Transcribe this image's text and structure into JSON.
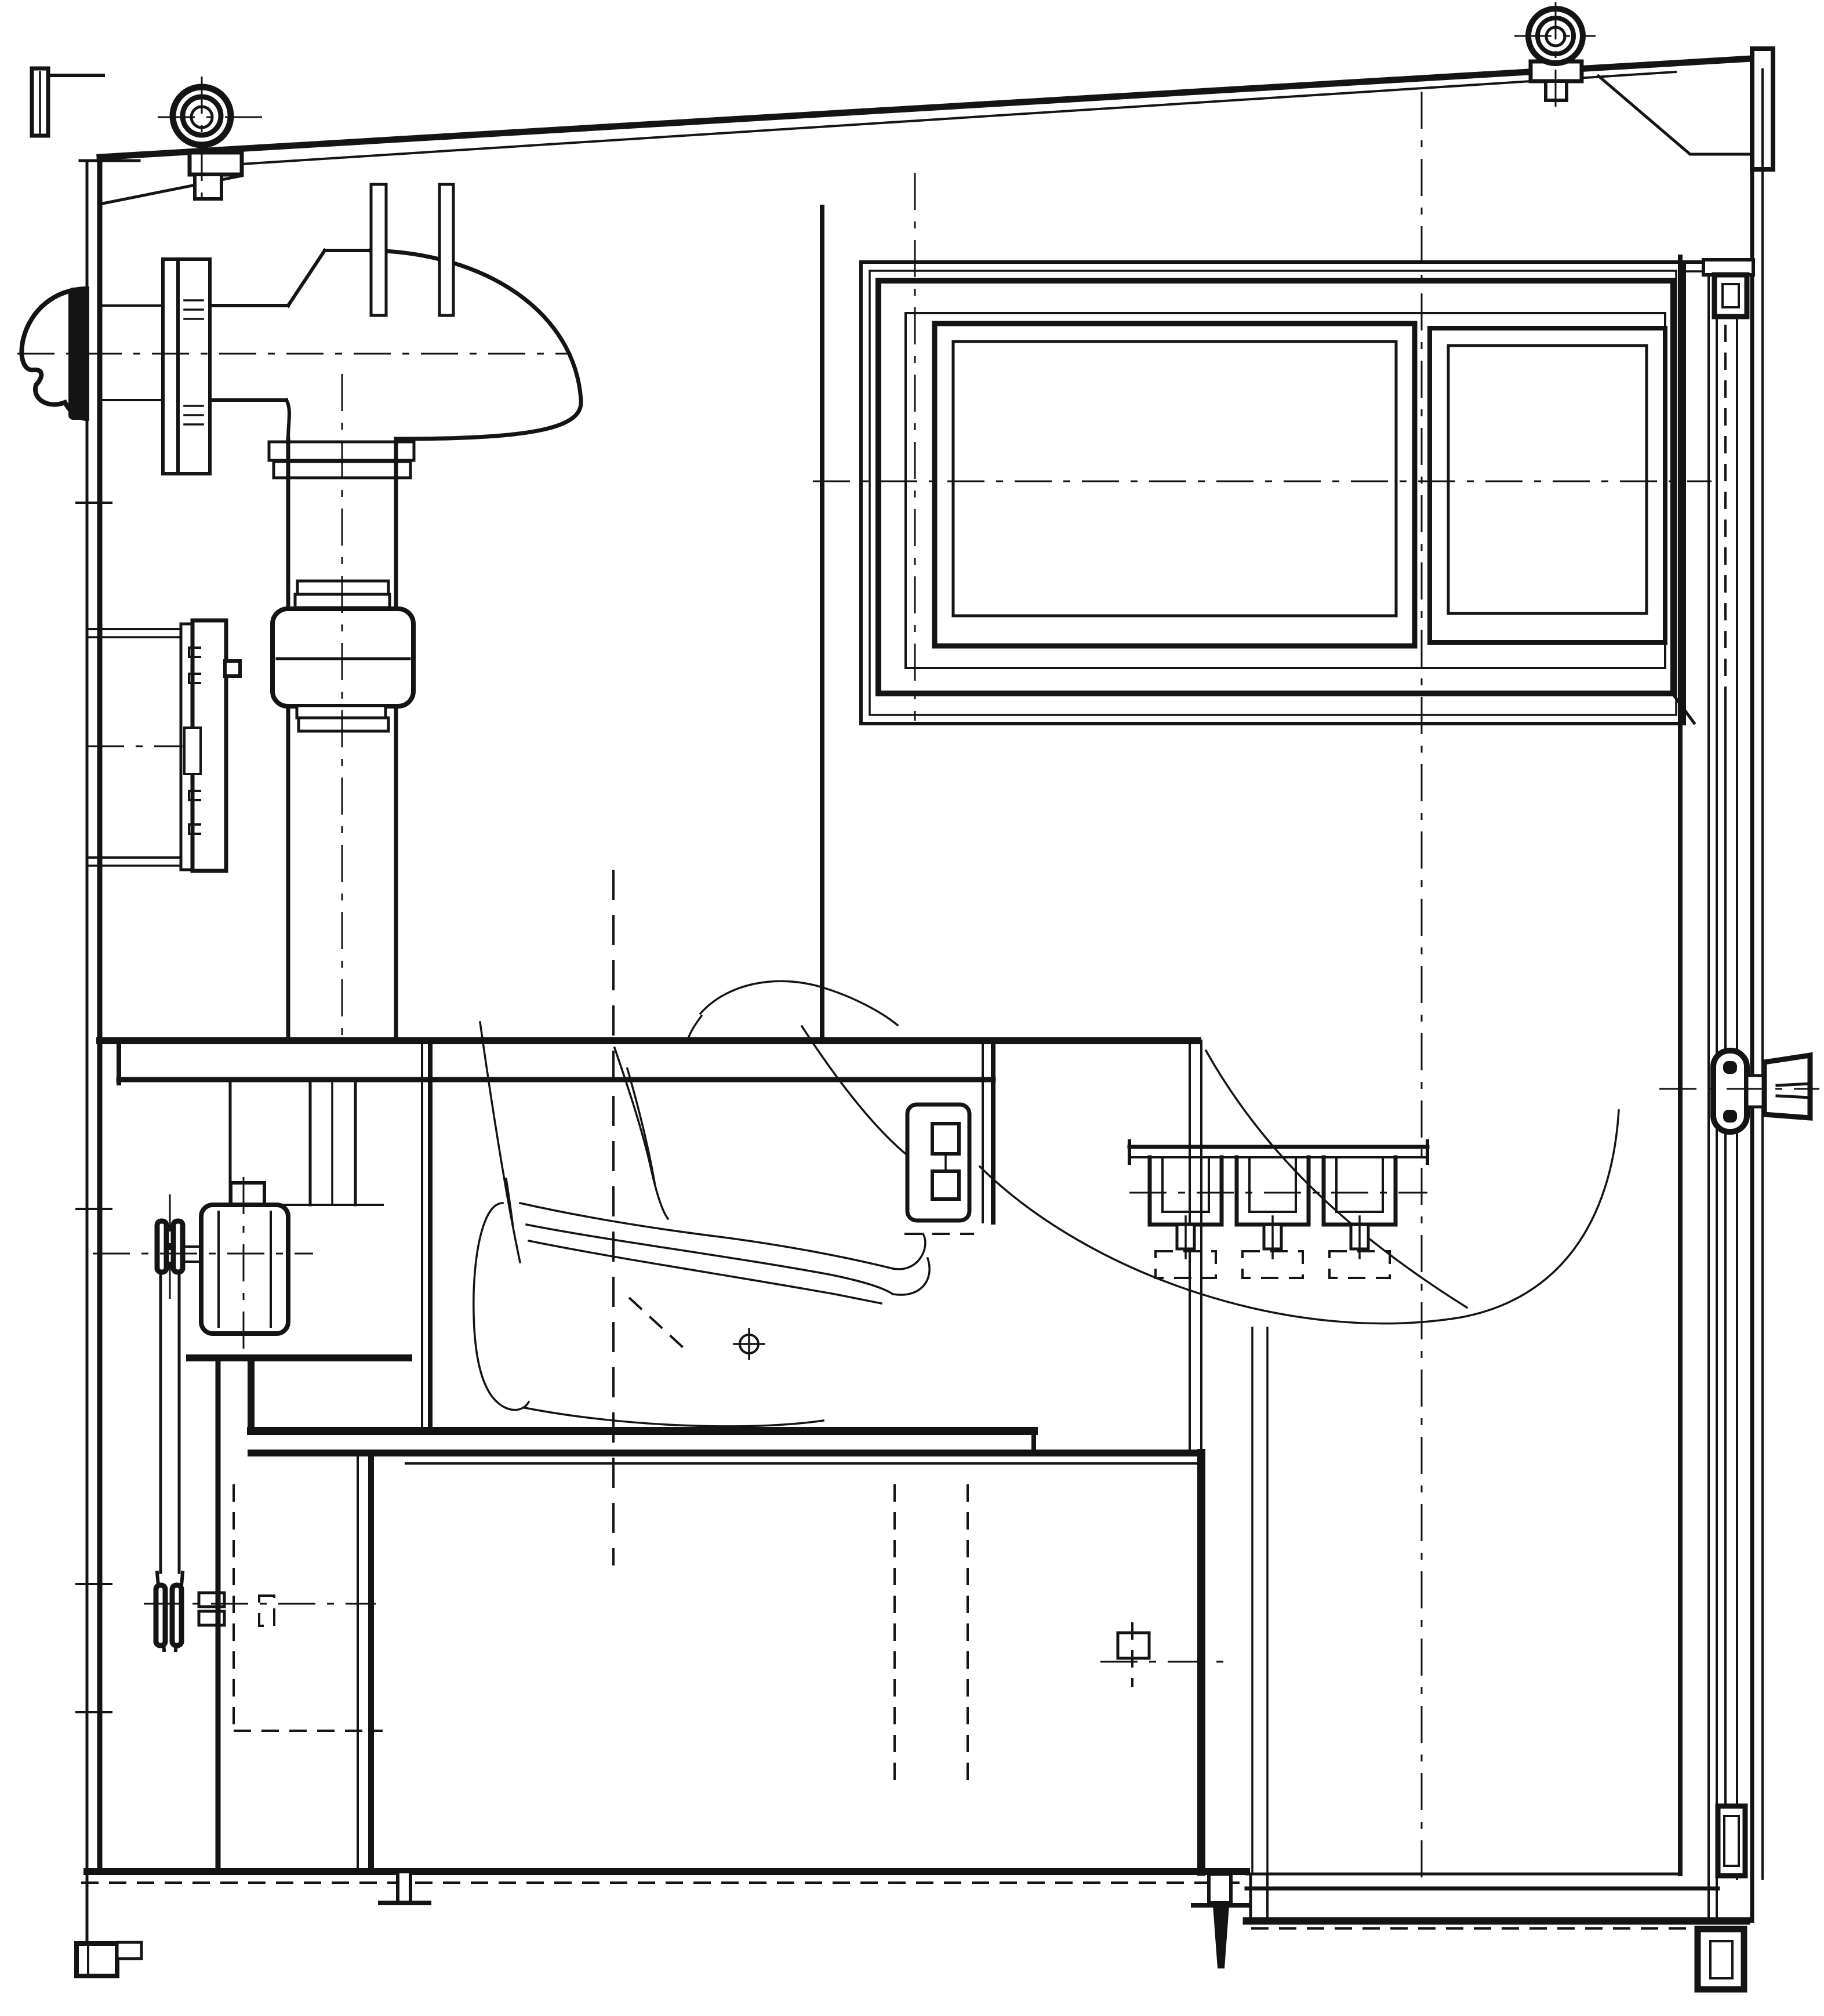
{
  "drawing": {
    "title": "",
    "ink_color": "#141414",
    "paper_color": "#ffffff",
    "components": {
      "roof": "sloped roof edge",
      "left_eave": "left eave channel bracket",
      "lifting_eye_left": "left lifting eye bolt",
      "lifting_eye_right": "right lifting eye bolt",
      "right_eave": "right eave gusset and fascia",
      "left_wall": "left cabin wall",
      "intake_cowl": "exterior intake weather cowl",
      "wall_flange": "intake wall flange plates",
      "intake_duct": "horizontal intake duct",
      "duct_elbow": "duct elbow bend",
      "duct_riser": "vertical duct riser",
      "flexible_coupling": "flexible duct coupling",
      "louver_panel": "wall access louver panel",
      "partition_line": "interior partition edge",
      "sliding_window": "sliding window assembly",
      "window_pane_left": "left window pane",
      "window_pane_right": "right window pane",
      "shelf": "interior shelf bench",
      "seat_box": "seat support box and tank flange band",
      "seat_sketch": "operator seat phantom sketch",
      "control_box": "seat side control box",
      "hanger_rail": "bracket rail with three hangers",
      "motor": "blower drive motor",
      "chain_drive": "chain drive and sprockets",
      "chain_guard": "chain guard edge",
      "tank": "lower tank body",
      "tank_fitting": "tank wall fitting",
      "base": "base frame and floor line",
      "feet": "mounting feet",
      "door": "right side door edge",
      "door_latch": "door top latch",
      "door_knob": "door handle knob",
      "centerlines": "center and hidden lines"
    }
  }
}
